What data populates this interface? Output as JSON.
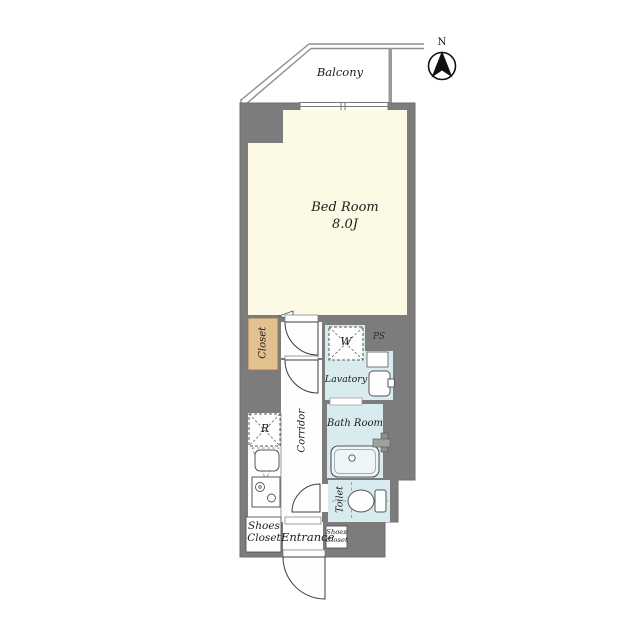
{
  "floor_plan": {
    "balcony": {
      "label": "Balcony"
    },
    "compass": {
      "north_label": "N"
    },
    "rooms": {
      "bedroom": {
        "label": "Bed Room",
        "size": "8.0J"
      },
      "closet": {
        "label": "Closet"
      },
      "lavatory": {
        "label": "Lavatory"
      },
      "bathroom": {
        "label": "Bath Room"
      },
      "toilet": {
        "label": "Toilet"
      },
      "corridor": {
        "label": "Corridor"
      },
      "entrance": {
        "label": "Entrance"
      },
      "shoes_closet": {
        "label": "Shoes Closet"
      },
      "shoes_closet_small": {
        "label": "Shoes Closet"
      },
      "pipe_shaft": {
        "label": "PS"
      }
    },
    "fixtures": {
      "washer": {
        "label": "W"
      },
      "refrigerator": {
        "label": "R"
      }
    },
    "colors": {
      "wall": "#7c7c7c",
      "bedroom_floor": "#fcf9e4",
      "wet_area_floor": "#d8ecf0",
      "closet_floor": "#e2c090",
      "room_white": "#fefefe",
      "line": "#555555"
    }
  }
}
